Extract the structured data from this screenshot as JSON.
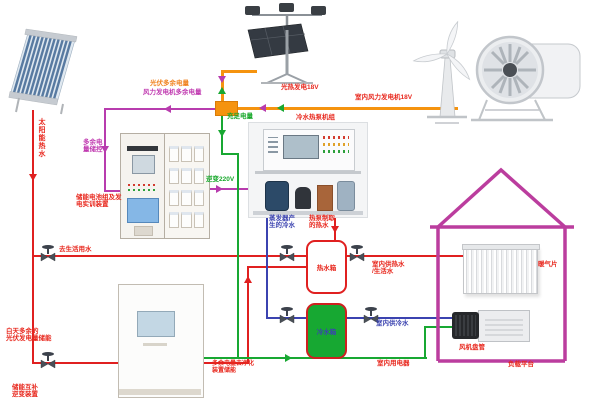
{
  "title": "风光互补冷暖系统实训平台示意图",
  "labels": {
    "solar_hot_water": "太阳能热水",
    "pv_excess": "光伏多余电量",
    "wind_excess": "风力发电机多余电量",
    "pv_generation": "光热发电18V",
    "indoor_wind_generation": "室内风力发电机18V",
    "sufficient_power": "充足电量",
    "chiller_unit": "冷水热泵机组",
    "excess_storage_ctrl": "多余电量储控",
    "battery_device": "储能电池组及发\n电实训装置",
    "inverter_220v": "逆变220V",
    "domestic_water": "去生活用水",
    "evaporator_cold": "蒸发器产\n生的冷水",
    "heatpump_hot": "热泵制取\n的热水",
    "hot_tank": "热水箱",
    "indoor_hot_supply": "室内供热水\n/生活水",
    "radiator": "暖气片",
    "cold_tank": "冷水箱",
    "indoor_cold_supply": "室内供冷水",
    "indoor_appliances": "室内用电器",
    "fan_coil": "风机盘管",
    "load_platform": "负载平台",
    "daytime_excess": "白天多余的\n光伏发电量储能",
    "excess_to_storage": "多余电量去净化\n装置储能",
    "storage_inverter": "储能互补\n逆变装置"
  },
  "icons": {
    "valve": "gate-valve-icon",
    "arrow": "flow-direction-arrow"
  },
  "colors": {
    "hot_water_line": "#e02020",
    "cold_water_line": "#3b43b0",
    "power_line_orange": "#f5930f",
    "excess_power_line": "#b83cae",
    "grid_power_line": "#18a832",
    "house_outline": "#bb3d9e",
    "hot_tank_border": "#e02020",
    "cold_tank_fill": "#17a832"
  }
}
